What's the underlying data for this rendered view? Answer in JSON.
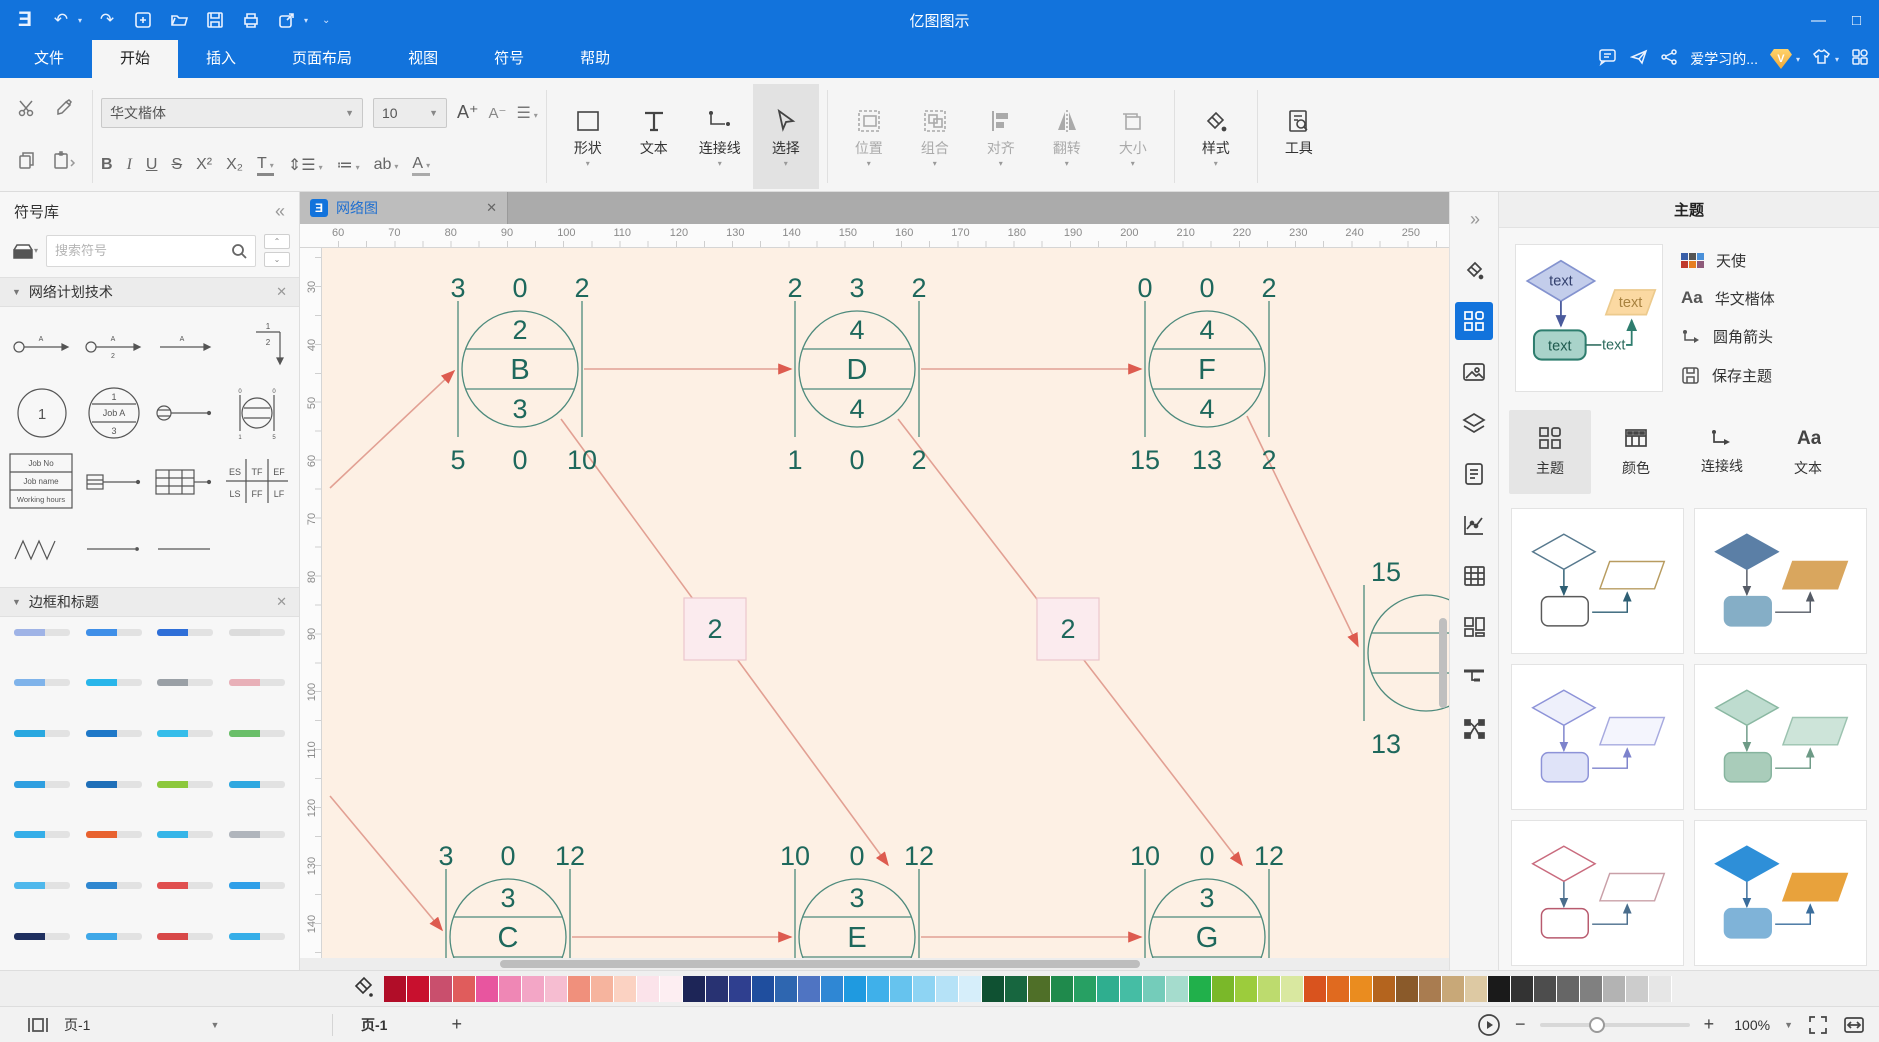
{
  "titlebar": {
    "title": "亿图图示"
  },
  "menubar": {
    "tabs": [
      {
        "label": "文件",
        "active": false
      },
      {
        "label": "开始",
        "active": true
      },
      {
        "label": "插入",
        "active": false
      },
      {
        "label": "页面布局",
        "active": false
      },
      {
        "label": "视图",
        "active": false
      },
      {
        "label": "符号",
        "active": false
      },
      {
        "label": "帮助",
        "active": false
      }
    ],
    "account": "爱学习的...",
    "vip_badge": "V"
  },
  "ribbon": {
    "font_name": "华文楷体",
    "font_size": "10",
    "bold": "B",
    "italic": "I",
    "underline": "U",
    "strike": "S",
    "superscript": "X²",
    "subscript": "X₂",
    "text_color": "T",
    "highlight": "ab",
    "font_color2": "A",
    "inc_font": "A⁺",
    "dec_font": "A⁻",
    "shape_buttons": [
      {
        "label": "形状",
        "caret": true,
        "active": false
      },
      {
        "label": "文本",
        "caret": false,
        "active": false
      },
      {
        "label": "连接线",
        "caret": true,
        "active": false
      },
      {
        "label": "选择",
        "caret": true,
        "active": true
      }
    ],
    "arrange_buttons": [
      {
        "label": "位置"
      },
      {
        "label": "组合"
      },
      {
        "label": "对齐"
      },
      {
        "label": "翻转"
      },
      {
        "label": "大小"
      }
    ],
    "style_button": "样式",
    "tool_button": "工具"
  },
  "sidebar": {
    "title": "符号库",
    "search_placeholder": "搜索符号",
    "section1": "网络计划技术",
    "section2": "边框和标题",
    "symbols": {
      "arrow_label": "A",
      "circle_one": "1",
      "job_a_top": "1",
      "job_a": "Job A",
      "job_a_bottom": "3",
      "frac_top": "1",
      "frac_bottom": "2",
      "job_no": "Job No",
      "job_name": "Job name",
      "working_hours": "Working hours",
      "es": "ES",
      "tf": "TF",
      "ef": "EF",
      "ls": "LS",
      "ff": "FF",
      "lf": "LF"
    },
    "border_bars": [
      [
        "#9fb3e6",
        "#3f8fe8",
        "#2f6fd8",
        "#dcdcdc"
      ],
      [
        "#7fb3ea",
        "#29b6ea",
        "#9aa0a6",
        "#e8b0b8"
      ],
      [
        "#29a8e0",
        "#1f78c8",
        "#35bdea",
        "#6abf69"
      ],
      [
        "#2f9fe0",
        "#1f6fb8",
        "#8cc83c",
        "#2fa8e0"
      ],
      [
        "#35aee8",
        "#e8622f",
        "#35b5e8",
        "#b0b5bc"
      ],
      [
        "#4fb8ec",
        "#2f87d0",
        "#e04f4f",
        "#2f9fe8"
      ],
      [
        "#1f2f5f",
        "#3fa8e8",
        "#d84848",
        "#35aee8"
      ]
    ]
  },
  "canvas": {
    "tab_label": "网络图",
    "colors": {
      "bg": "#fdf0e4",
      "node_stroke": "#4d8a7c",
      "node_text": "#1e685c",
      "edge": "#e2a093",
      "arrow": "#dd5b4f",
      "box_fill": "#fbebee",
      "box_stroke": "#ecc6cc"
    },
    "h_ruler": {
      "start": 60,
      "end": 250,
      "step": 10,
      "origin": 16,
      "px_per_step": 56.3
    },
    "v_ruler": {
      "start": 30,
      "end": 150,
      "step": 10,
      "origin": 33,
      "px_per_step": 57.9
    },
    "nodes": [
      {
        "letter": "B",
        "top": [
          "3",
          "0",
          "2"
        ],
        "upper": "2",
        "lower": "3",
        "bottom": [
          "5",
          "0",
          "10"
        ],
        "cx": 198,
        "cy": 121
      },
      {
        "letter": "D",
        "top": [
          "2",
          "3",
          "2"
        ],
        "upper": "4",
        "lower": "4",
        "bottom": [
          "1",
          "0",
          "2"
        ],
        "cx": 535,
        "cy": 121
      },
      {
        "letter": "F",
        "top": [
          "0",
          "0",
          "2"
        ],
        "upper": "4",
        "lower": "4",
        "bottom": [
          "15",
          "13",
          "2"
        ],
        "cx": 885,
        "cy": 121
      },
      {
        "letter": "C",
        "top": [
          "3",
          "0",
          "12"
        ],
        "upper": "3",
        "lower": "",
        "bottom": [],
        "cx": 186,
        "cy": 689
      },
      {
        "letter": "E",
        "top": [
          "10",
          "0",
          "12"
        ],
        "upper": "3",
        "lower": "",
        "bottom": [],
        "cx": 535,
        "cy": 689
      },
      {
        "letter": "G",
        "top": [
          "10",
          "0",
          "12"
        ],
        "upper": "3",
        "lower": "",
        "bottom": [],
        "cx": 885,
        "cy": 689
      }
    ],
    "partial_node": {
      "top": "15",
      "bottom": "13",
      "cx": 1104,
      "cy": 405
    },
    "duration_boxes": [
      {
        "label": "2",
        "cx": 393,
        "cy": 381
      },
      {
        "label": "2",
        "cx": 746,
        "cy": 381
      }
    ],
    "edges": [
      {
        "from": [
          8,
          240
        ],
        "to": [
          132,
          123
        ]
      },
      {
        "from": [
          262,
          121
        ],
        "to": [
          469,
          121
        ]
      },
      {
        "from": [
          599,
          121
        ],
        "to": [
          819,
          121
        ]
      },
      {
        "from": [
          239,
          171
        ],
        "to": [
          566,
          617
        ]
      },
      {
        "from": [
          576,
          171
        ],
        "to": [
          920,
          617
        ]
      },
      {
        "from": [
          925,
          168
        ],
        "to": [
          1036,
          398
        ]
      },
      {
        "from": [
          8,
          548
        ],
        "to": [
          120,
          682
        ]
      },
      {
        "from": [
          250,
          689
        ],
        "to": [
          469,
          689
        ]
      },
      {
        "from": [
          599,
          689
        ],
        "to": [
          819,
          689
        ]
      }
    ]
  },
  "theme_panel": {
    "title": "主题",
    "current": {
      "name": "天使",
      "font": "华文楷体",
      "connector": "圆角箭头",
      "save": "保存主题",
      "preview_label": "text",
      "palette_colors": [
        "#3a5fa8",
        "#555555",
        "#4a90d9",
        "#c0392b",
        "#e67e22",
        "#8e5a7a"
      ]
    },
    "tabs": [
      {
        "label": "主题",
        "active": true
      },
      {
        "label": "颜色",
        "active": false
      },
      {
        "label": "连接线",
        "active": false
      },
      {
        "label": "文本",
        "active": false
      }
    ],
    "cards": [
      {
        "df": "#ffffff",
        "ds": "#57798e",
        "pf": "#ffffff",
        "ps": "#b89c60",
        "rf": "#ffffff",
        "rs": "#5a5a5a",
        "ar": "#2e5f74"
      },
      {
        "df": "#5b7fa6",
        "ds": "#5b7fa6",
        "pf": "#d9a65e",
        "ps": "#d9a65e",
        "rf": "#85aec6",
        "rs": "#85aec6",
        "ar": "#555b66"
      },
      {
        "df": "#eef0fb",
        "ds": "#8d93d8",
        "pf": "#f4f5fd",
        "ps": "#a7aadf",
        "rf": "#dfe3f8",
        "rs": "#8d93d8",
        "ar": "#7d83cc"
      },
      {
        "df": "#bedccf",
        "ds": "#8ab8a2",
        "pf": "#cde4d9",
        "ps": "#9cc3b0",
        "rf": "#a9ccba",
        "rs": "#86b49e",
        "ar": "#6d9a86"
      },
      {
        "df": "#ffffff",
        "ds": "#c96b7e",
        "pf": "#ffffff",
        "ps": "#c9a0a8",
        "rf": "#ffffff",
        "rs": "#b85a6e",
        "ar": "#4a6d8c"
      },
      {
        "df": "#2e8fd8",
        "ds": "#2e8fd8",
        "pf": "#e8a23c",
        "ps": "#e8a23c",
        "rf": "#7fb3d8",
        "rs": "#7fb3d8",
        "ar": "#3a6d9c"
      }
    ]
  },
  "colorbar": {
    "swatches": [
      "#b10d28",
      "#c8102e",
      "#c94f6d",
      "#e05c5c",
      "#e8559f",
      "#ef87b5",
      "#f3a6c6",
      "#f6bdd1",
      "#f0907c",
      "#f6b49e",
      "#fbd2c2",
      "#fbe3ea",
      "#fdeef2",
      "#1d2557",
      "#283272",
      "#2f3f8f",
      "#1f4e9e",
      "#2e66b0",
      "#4f74c2",
      "#2f87d4",
      "#1f9ae0",
      "#3fb0ea",
      "#66c3ee",
      "#8ed4f3",
      "#b5e2f7",
      "#d6eefa",
      "#0f5132",
      "#17663f",
      "#4f6f28",
      "#1f8a4c",
      "#27a063",
      "#2fae8f",
      "#45bda4",
      "#74ccba",
      "#a5dccd",
      "#21b04b",
      "#7ab829",
      "#9ccc3c",
      "#bddb6e",
      "#d9e8a0",
      "#d9531e",
      "#e06a1f",
      "#ea8c1f",
      "#b4641e",
      "#8a5a2a",
      "#a97c50",
      "#c8a878",
      "#ddc9a3",
      "#1a1a1a",
      "#333333",
      "#4d4d4d",
      "#666666",
      "#808080",
      "#b3b3b3",
      "#cccccc",
      "#e6e6e6"
    ]
  },
  "statusbar": {
    "page_select": "页-1",
    "page_tab": "页-1",
    "add_page": "+",
    "zoom": "100%"
  }
}
